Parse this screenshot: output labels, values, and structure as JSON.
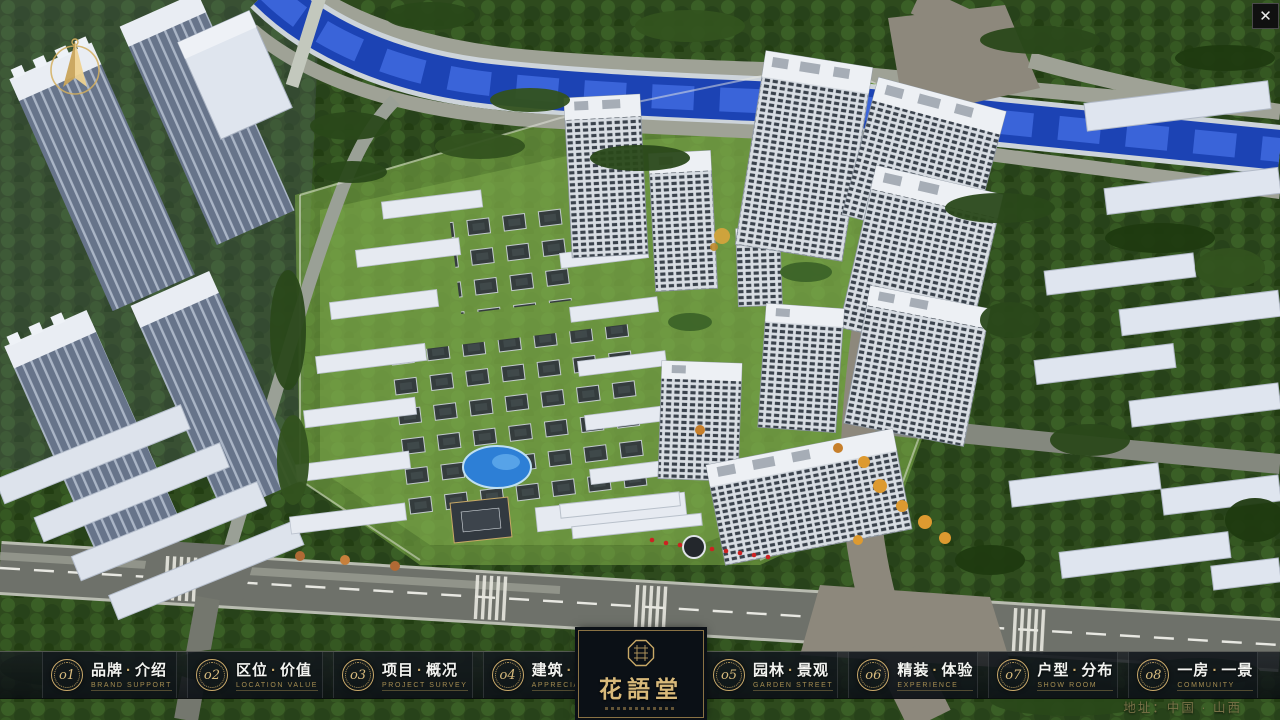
{
  "window": {
    "close_glyph": "✕"
  },
  "nav": {
    "separator": "·",
    "items": [
      {
        "num": "o1",
        "zh_a": "品牌",
        "zh_b": "介绍",
        "sub": "BRAND SUPPORT"
      },
      {
        "num": "o2",
        "zh_a": "区位",
        "zh_b": "价值",
        "sub": "LOCATION VALUE"
      },
      {
        "num": "o3",
        "zh_a": "项目",
        "zh_b": "概况",
        "sub": "PROJECT SURVEY"
      },
      {
        "num": "o4",
        "zh_a": "建筑",
        "zh_b": "鉴赏",
        "sub": "APPRECIATION"
      },
      {
        "num": "o5",
        "zh_a": "园林",
        "zh_b": "景观",
        "sub": "GARDEN STREET"
      },
      {
        "num": "o6",
        "zh_a": "精装",
        "zh_b": "体验",
        "sub": "EXPERIENCE"
      },
      {
        "num": "o7",
        "zh_a": "户型",
        "zh_b": "分布",
        "sub": "SHOW ROOM"
      },
      {
        "num": "o8",
        "zh_a": "一房",
        "zh_b": "一景",
        "sub": "COMMUNITY"
      }
    ],
    "logo": {
      "title": "花語堂"
    },
    "address": "地址：中国 · 山西"
  },
  "palette": {
    "accent_gold": "#c9a96a",
    "nav_bg": "#12181e",
    "text_white": "#f3f4f1",
    "text_gold_muted": "#a58d52",
    "river_blue": "#2550c8",
    "tree_green": "#2e4a1d",
    "lawn_green": "#7dab48",
    "road_gray": "#6e716a",
    "boulevard_tan": "#8d887c",
    "building_white": "#e7ebf1"
  }
}
